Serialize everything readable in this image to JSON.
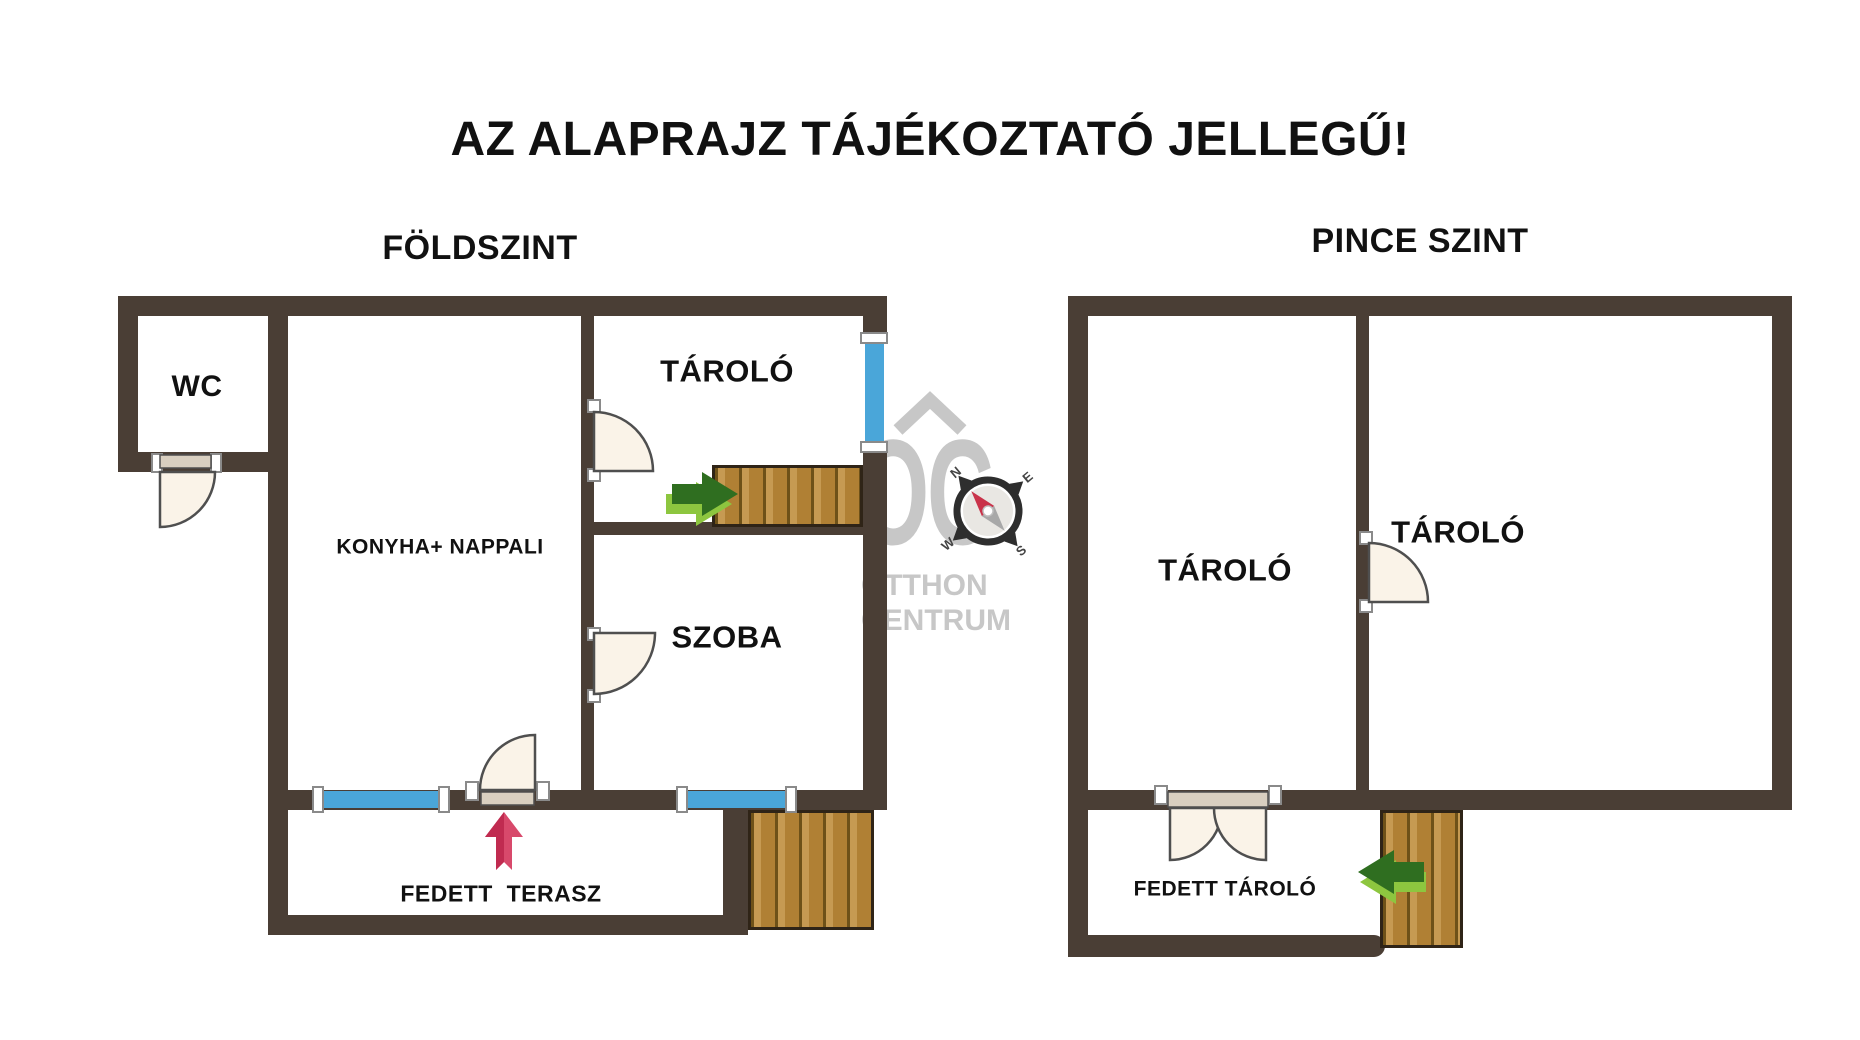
{
  "title": "AZ ALAPRAJZ TÁJÉKOZTATÓ JELLEGŰ!",
  "floors": {
    "ground": {
      "label": "FÖLDSZINT",
      "rooms": {
        "wc": "WC",
        "kitchen_living": "KONYHA+ NAPPALI",
        "storage": "TÁROLÓ",
        "room": "SZOBA",
        "covered_terrace": "FEDETT  TERASZ"
      }
    },
    "basement": {
      "label": "PINCE SZINT",
      "rooms": {
        "storage_left": "TÁROLÓ",
        "storage_right": "TÁROLÓ",
        "covered_storage": "FEDETT TÁROLÓ"
      }
    }
  },
  "watermark": {
    "brand_initials": "OC",
    "brand_line1": "OTTHON",
    "brand_line2": "CENTRUM"
  },
  "compass": {
    "n": "N",
    "e": "E",
    "s": "S",
    "w": "W"
  },
  "colors": {
    "bg": "#ffffff",
    "wall": "#4a3e35",
    "text_black": "#111111",
    "wood_light": "#c69a52",
    "wood_mid": "#b08034",
    "wood_dark": "#6e5118",
    "wood_border": "#2f2417",
    "window_blue": "#4aa6d9",
    "door_fill": "#faf3e8",
    "door_stroke": "#4f4f4f",
    "door_slab": "#d9cfc0",
    "bracket_fill": "#ffffff",
    "bracket_stroke": "#8a8a8a",
    "arrow_red": "#d8496b",
    "arrow_red_dark": "#c02b50",
    "arrow_green_dark": "#2f6e20",
    "arrow_green_light": "#8dc63f",
    "watermark_gray": "#c7c7c7",
    "compass_dark": "#2e2e2e",
    "compass_red": "#c9334a",
    "compass_gray": "#a8a8a8"
  }
}
